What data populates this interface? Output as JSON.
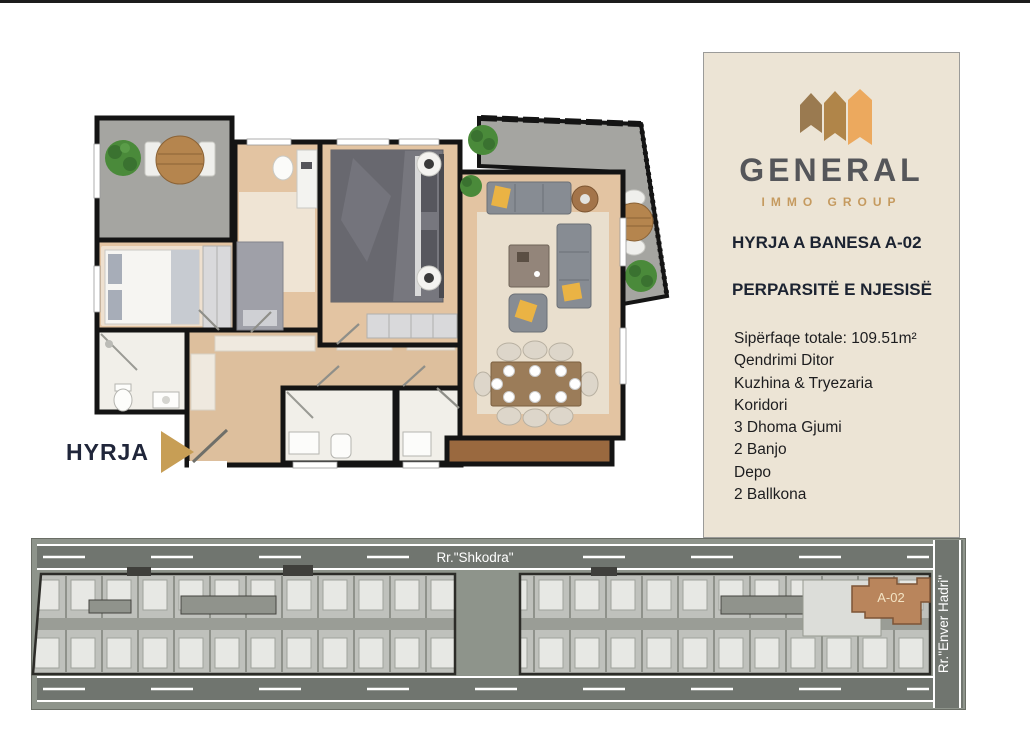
{
  "floor_plan": {
    "entrance_label": "HYRJA"
  },
  "panel": {
    "brand_name": "GENERAL",
    "brand_subtitle": "IMMO GROUP",
    "title": "HYRJA A BANESA A-02",
    "subtitle": "PERPARSITË E NJESISË",
    "features": [
      "Sipërfaqe totale: 109.51m²",
      "Qendrimi Ditor",
      "Kuzhina & Tryezaria",
      "Koridori",
      "3 Dhoma Gjumi",
      "2 Banjo",
      "Depo",
      "2 Ballkona"
    ]
  },
  "site_plan": {
    "street_top": "Rr.\"Shkodra\"",
    "street_right": "Rr.\"Enver Hadri\"",
    "unit_label": "A-02"
  },
  "colors": {
    "panel_background": "#ece4d5",
    "brand_gray": "#55565a",
    "brand_gold": "#c59a5f",
    "heading_navy": "#1c2331",
    "entrance_arrow_gold": "#c79e55",
    "unit_highlight_tan": "#b9855c",
    "road_gray": "#70756f",
    "site_background": "#8e948b",
    "wood_floor": "#e3c4a2",
    "balcony_gray": "#a5a5a1"
  }
}
